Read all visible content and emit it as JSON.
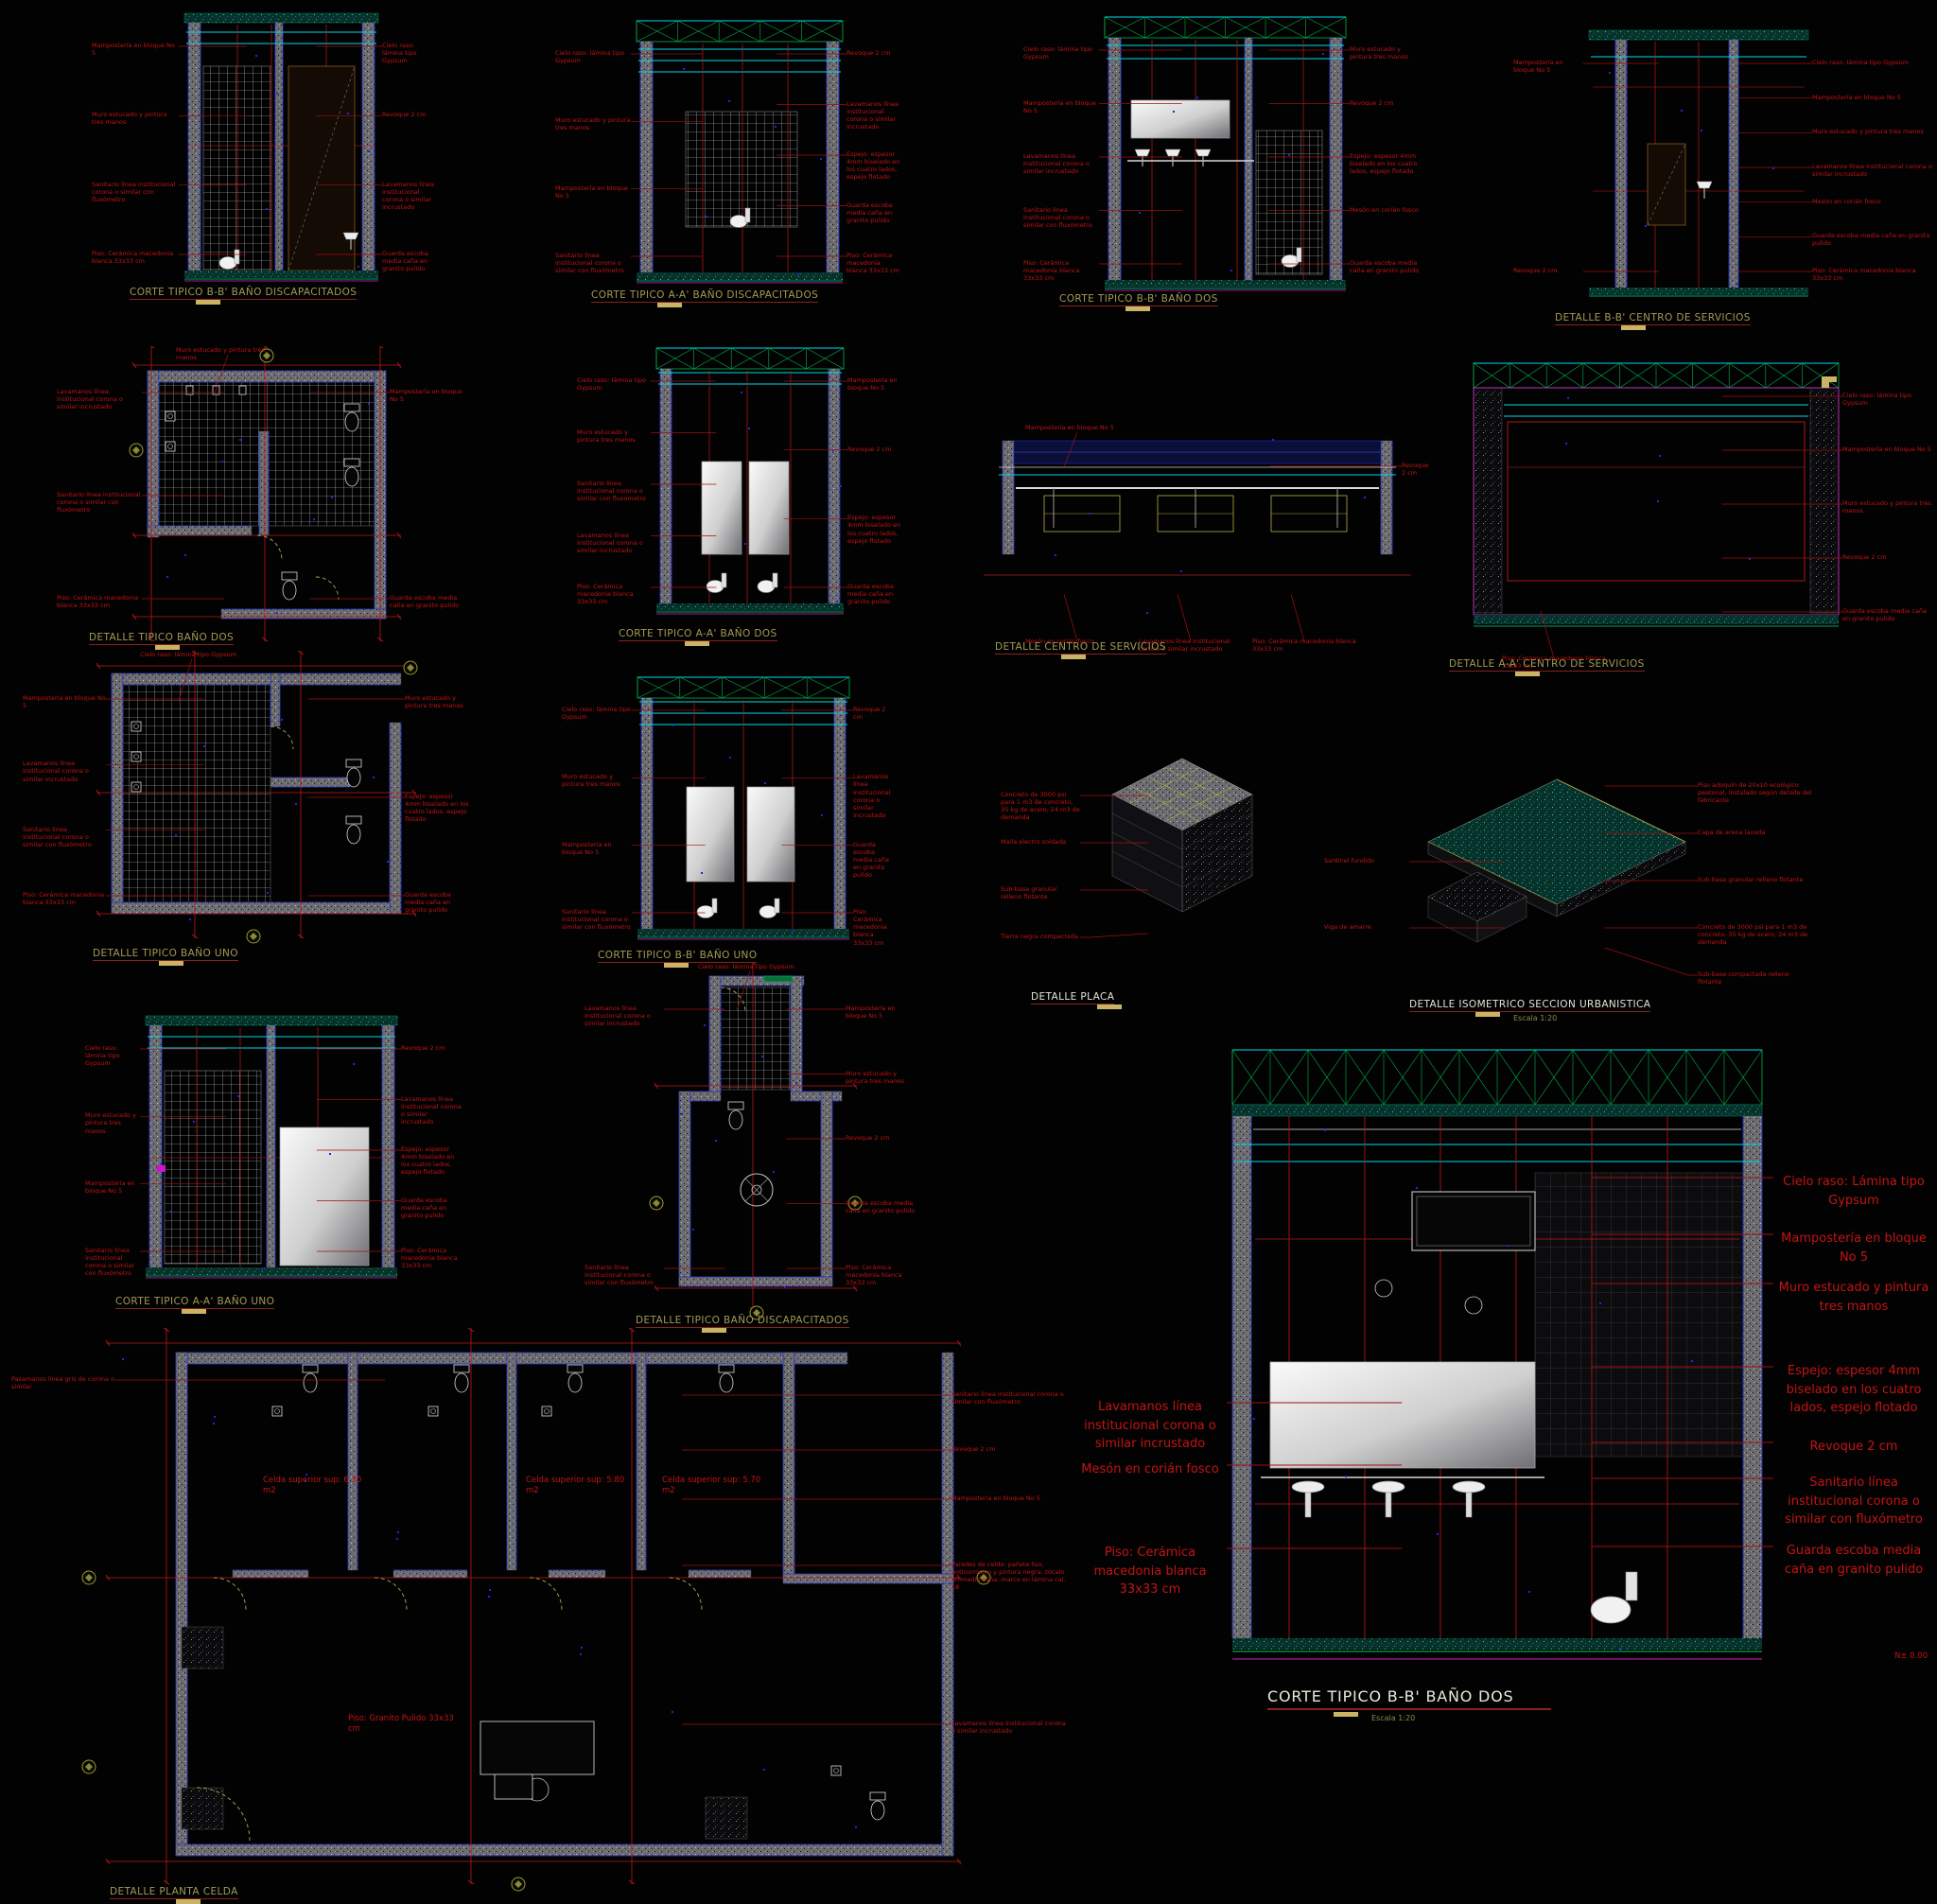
{
  "app": {
    "type": "cad-model-space",
    "background": "#000000"
  },
  "colors": {
    "annotation_red": "#c31414",
    "leader_red": "#9e1010",
    "title_khaki": "#a39a55",
    "title_white": "#e4e4da",
    "underline_red": "#86231a",
    "scale_bar_yellow": "#c9b466",
    "cyan": "#00d9e8",
    "truss_green": "#00b34a",
    "floor_teal": "#18a98b",
    "magenta": "#c434c4",
    "wall_gray": "#6b6b70",
    "blue_marker": "#2525e0",
    "wall_edge_blue": "#2836c8",
    "furniture_yellow": "#b5ae42"
  },
  "drawings": [
    {
      "id": "corte-bb-bano-discapacitados",
      "title": "CORTE TIPICO B-B' BAÑO DISCAPACITADOS",
      "annotations": {
        "left": [
          "Mampostería en bloque No 5",
          "Muro estucado y pintura tres manos",
          "Sanitario línea institucional corona o similar con fluxómetro",
          "Piso: Cerámica macedonia blanca 33x33 cm"
        ],
        "right": [
          "Cielo raso: lámina tipo Gypsum",
          "Revoque 2 cm",
          "Lavamanos línea institucional corona o similar incrustado",
          "Guarda escoba media caña en granito pulido"
        ]
      }
    },
    {
      "id": "corte-aa-bano-discapacitados",
      "title": "CORTE TIPICO A-A' BAÑO DISCAPACITADOS",
      "annotations": {
        "left": [
          "Cielo raso: lámina tipo Gypsum",
          "Muro estucado y pintura tres manos",
          "Mampostería en bloque No 5",
          "Sanitario línea institucional corona o similar con fluxómetro"
        ],
        "right": [
          "Revoque 2 cm",
          "Lavamanos línea institucional corona o similar incrustado",
          "Espejo: espesor 4mm biselado en los cuatro lados, espejo flotado",
          "Guarda escoba media caña en granito pulido",
          "Piso: Cerámica macedonia blanca 33x33 cm"
        ]
      }
    },
    {
      "id": "corte-bb-bano-dos",
      "title": "CORTE TIPICO B-B' BAÑO DOS",
      "annotations": {
        "left": [
          "Cielo raso: lámina tipo Gypsum",
          "Mampostería en bloque No 5",
          "Lavamanos línea institucional corona o similar incrustado",
          "Sanitario línea institucional corona o similar con fluxómetro",
          "Piso: Cerámica macedonia blanca 33x33 cm"
        ],
        "right": [
          "Muro estucado y pintura tres manos",
          "Revoque 2 cm",
          "Espejo: espesor 4mm biselado en los cuatro lados, espejo flotado",
          "Mesón en corián fosco",
          "Guarda escoba media caña en granito pulido"
        ]
      }
    },
    {
      "id": "detalle-bb-centro-servicios",
      "title": "DETALLE B-B' CENTRO DE SERVICIOS",
      "annotations": {
        "left": [
          "Mampostería en bloque No 5",
          "Revoque 2 cm"
        ],
        "right": [
          "Cielo raso: lámina tipo Gypsum",
          "Mampostería en bloque No 5",
          "Muro estucado y pintura tres manos",
          "Lavamanos línea institucional corona o similar incrustado",
          "Mesón en corián fosco",
          "Guarda escoba media caña en granito pulido",
          "Piso: Cerámica macedonia blanca 33x33 cm"
        ]
      }
    },
    {
      "id": "detalle-tipico-bano-dos",
      "title": "DETALLE TIPICO BAÑO DOS",
      "annotations": {
        "left": [
          "Lavamanos línea institucional corona o similar incrustado",
          "Sanitario línea institucional corona o similar con fluxómetro",
          "Piso: Cerámica macedonia blanca 33x33 cm"
        ],
        "right": [
          "Mampostería en bloque No 5",
          "Guarda escoba media caña en granito pulido"
        ],
        "top": [
          "Muro estucado y pintura tres manos"
        ]
      }
    },
    {
      "id": "corte-aa-bano-dos",
      "title": "CORTE TIPICO A-A' BAÑO DOS",
      "annotations": {
        "left": [
          "Cielo raso: lámina tipo Gypsum",
          "Muro estucado y pintura tres manos",
          "Sanitario línea institucional corona o similar con fluxómetro",
          "Lavamanos línea institucional corona o similar incrustado",
          "Piso: Cerámica macedonia blanca 33x33 cm"
        ],
        "right": [
          "Mampostería en bloque No 5",
          "Revoque 2 cm",
          "Espejo: espesor 4mm biselado en los cuatro lados, espejo flotado",
          "Guarda escoba media caña en granito pulido"
        ]
      }
    },
    {
      "id": "detalle-centro-servicios",
      "title": "DETALLE CENTRO DE SERVICIOS",
      "annotations": {
        "bottom": [
          "Mesón en corián fosco",
          "Lavamanos línea institucional corona o similar incrustado",
          "Piso: Cerámica macedonia blanca 33x33 cm"
        ],
        "right": [
          "Revoque 2 cm"
        ],
        "top": [
          "Mampostería en bloque No 5"
        ]
      }
    },
    {
      "id": "detalle-aa-centro-servicios",
      "title": "DETALLE A-A' CENTRO DE SERVICIOS",
      "annotations": {
        "right": [
          "Cielo raso: lámina tipo Gypsum",
          "Mampostería en bloque No 5",
          "Muro estucado y pintura tres manos",
          "Revoque 2 cm",
          "Guarda escoba media caña en granito pulido"
        ],
        "bottom": [
          "Piso: Cerámica macedonia blanca 33x33 cm"
        ]
      }
    },
    {
      "id": "detalle-tipico-bano-uno",
      "title": "DETALLE TIPICO BAÑO UNO",
      "annotations": {
        "left": [
          "Mampostería en bloque No 5",
          "Lavamanos línea institucional corona o similar incrustado",
          "Sanitario línea institucional corona o similar con fluxómetro",
          "Piso: Cerámica macedonia blanca 33x33 cm"
        ],
        "right": [
          "Muro estucado y pintura tres manos",
          "Espejo: espesor 4mm biselado en los cuatro lados, espejo flotado",
          "Guarda escoba media caña en granito pulido"
        ],
        "top": [
          "Cielo raso: lámina tipo Gypsum"
        ]
      }
    },
    {
      "id": "corte-bb-bano-uno",
      "title": "CORTE TIPICO B-B' BAÑO UNO",
      "annotations": {
        "left": [
          "Cielo raso: lámina tipo Gypsum",
          "Muro estucado y pintura tres manos",
          "Mampostería en bloque No 5",
          "Sanitario línea institucional corona o similar con fluxómetro"
        ],
        "right": [
          "Revoque 2 cm",
          "Lavamanos línea institucional corona o similar incrustado",
          "Guarda escoba media caña en granito pulido",
          "Piso: Cerámica macedonia blanca 33x33 cm"
        ]
      }
    },
    {
      "id": "detalle-placa",
      "title": "DETALLE PLACA",
      "annotations": {
        "left": [
          "Concreto de 3000 psi para 1 m3 de concreto, 35 kg de acero, 24 m3 de demanda",
          "Malla electro soldada",
          "Sub-base granular relleno flotante",
          "Tierra negra compactada"
        ]
      }
    },
    {
      "id": "detalle-isometrico-seccion-urbanistica",
      "title": "DETALLE ISOMETRICO SECCION URBANISTICA",
      "subtitle": "Escala 1:20",
      "annotations": {
        "left": [
          "Sardinel fundido",
          "Viga de amarre"
        ],
        "right": [
          "Piso adoquín de 20x10 ecológico peatonal, instalado según detalle del fabricante",
          "Capa de arena lavada",
          "Sub-base granular relleno flotante",
          "Concreto de 3000 psi para 1 m3 de concreto, 35 kg de acero, 24 m3 de demanda",
          "Sub-base compactada relleno flotante"
        ]
      }
    },
    {
      "id": "corte-aa-bano-uno",
      "title": "CORTE TIPICO A-A' BAÑO UNO",
      "annotations": {
        "left": [
          "Cielo raso: lámina tipo Gypsum",
          "Muro estucado y pintura tres manos",
          "Mampostería en bloque No 5",
          "Sanitario línea institucional corona o similar con fluxómetro"
        ],
        "right": [
          "Revoque 2 cm",
          "Lavamanos línea institucional corona o similar incrustado",
          "Espejo: espesor 4mm biselado en los cuatro lados, espejo flotado",
          "Guarda escoba media caña en granito pulido",
          "Piso: Cerámica macedonia blanca 33x33 cm"
        ]
      }
    },
    {
      "id": "detalle-tipico-bano-discapacitados",
      "title": "DETALLE TIPICO BAÑO DISCAPACITADOS",
      "annotations": {
        "left": [
          "Lavamanos línea institucional corona o similar incrustado",
          "Sanitario línea institucional corona o similar con fluxómetro"
        ],
        "right": [
          "Mampostería en bloque No 5",
          "Muro estucado y pintura tres manos",
          "Revoque 2 cm",
          "Guarda escoba media caña en granito pulido",
          "Piso: Cerámica macedonia blanca 33x33 cm"
        ],
        "top": [
          "Cielo raso: lámina tipo Gypsum"
        ]
      }
    },
    {
      "id": "detalle-planta-celda",
      "title": "DETALLE PLANTA CELDA",
      "annotations": {
        "left": [
          "Pasamanos línea gris de corona o similar"
        ],
        "right": [
          "Sanitario línea institucional corona o similar con fluxómetro",
          "Revoque 2 cm",
          "Mampostería en bloque No 5",
          "Paredes de celda: pañete liso, anticorrosivo y pintura negra, zócalo en media caña, marco en lámina cal. 18",
          "Lavamanos línea institucional corona o similar incrustado"
        ],
        "inner": [
          "Celda superior sup:   6.30 m2",
          "Celda superior sup:   5.80 m2",
          "Celda superior sup:   5.70 m2",
          "Piso: Granito Pulido 33x33 cm"
        ]
      }
    },
    {
      "id": "corte-bb-bano-dos-grande",
      "title": "CORTE TIPICO B-B' BAÑO DOS",
      "subtitle": "Escala 1:20",
      "annotations": {
        "left": [
          "Lavamanos línea institucional corona o similar incrustado",
          "Mesón en corián fosco",
          "Piso: Cerámica macedonia blanca 33x33 cm"
        ],
        "right": [
          "Cielo raso: Lámina tipo Gypsum",
          "Mampostería en bloque No 5",
          "Muro estucado y pintura tres manos",
          "Espejo: espesor 4mm biselado en los cuatro lados, espejo flotado",
          "Revoque 2 cm",
          "Sanitario línea institucional corona o similar con fluxómetro",
          "Guarda escoba media caña en granito pulido"
        ],
        "inner": [
          "N± 0.00"
        ]
      }
    }
  ]
}
